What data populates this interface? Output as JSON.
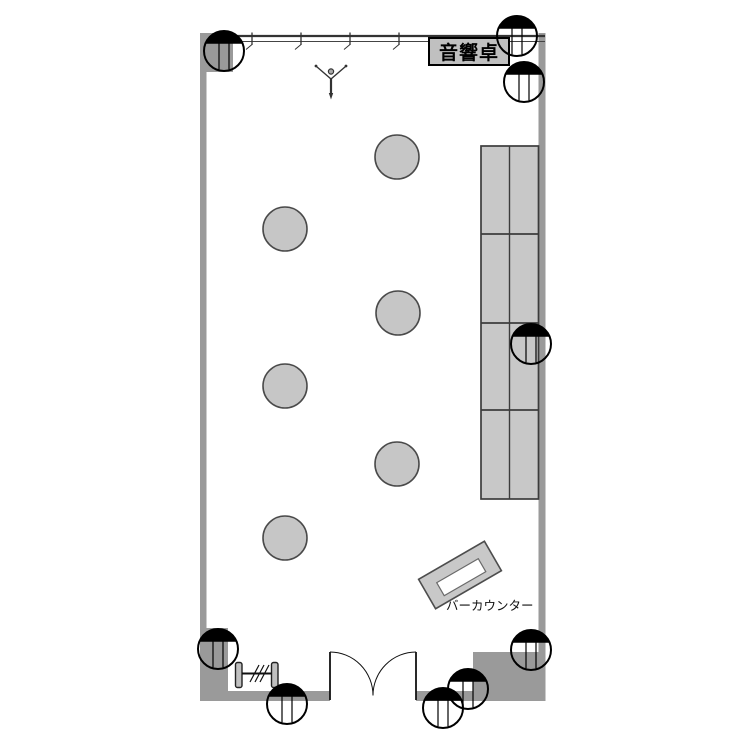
{
  "labels": {
    "sound_console": "音響卓",
    "bar_counter": "バーカウンター"
  },
  "palette": {
    "wall": "#9a9a9a",
    "furniture_fill": "#c8c8c8",
    "table_fill": "#c6c6c6",
    "console_fill": "#c0c0c0",
    "furniture_outline": "#4d4d4d",
    "ink": "#1a1a1a",
    "white": "#ffffff"
  },
  "plan": {
    "walls": [
      {
        "name": "left-wall",
        "x": 200,
        "y": 33,
        "w": 6.5,
        "h": 668
      },
      {
        "name": "top-left-wall-block",
        "x": 200,
        "y": 33,
        "w": 33,
        "h": 39
      },
      {
        "name": "right-wall",
        "x": 538.5,
        "y": 33,
        "w": 7,
        "h": 668
      },
      {
        "name": "bottom-left-wall-block",
        "x": 200,
        "y": 628,
        "w": 28,
        "h": 73
      },
      {
        "name": "bottom-wall-left",
        "x": 226,
        "y": 691,
        "w": 104,
        "h": 10
      },
      {
        "name": "bottom-wall-right",
        "x": 416,
        "y": 691,
        "w": 59,
        "h": 10
      },
      {
        "name": "bottom-right-wall-block",
        "x": 473,
        "y": 652,
        "w": 70,
        "h": 49
      }
    ],
    "window_wall": {
      "x1": 233,
      "x2": 545,
      "y_top": 36,
      "y_bottom": 41.5,
      "ticks": [
        252,
        301,
        350,
        399
      ]
    },
    "console_box": {
      "x": 429,
      "y": 38,
      "w": 80,
      "h": 27
    },
    "bench": {
      "x": 481,
      "y": 146,
      "w": 57.5,
      "h": 353,
      "divider_x": 509.5,
      "divider_ys": [
        234,
        323,
        410
      ]
    },
    "tables": {
      "radius": 22,
      "centers": [
        [
          397,
          157
        ],
        [
          285,
          229
        ],
        [
          398,
          313
        ],
        [
          285,
          386
        ],
        [
          397,
          464
        ],
        [
          285,
          538
        ]
      ]
    },
    "counter": {
      "cx": 460,
      "cy": 575,
      "rotation": -30,
      "outer_w": 76,
      "outer_h": 34,
      "inner": {
        "x": -24,
        "y": -5,
        "w": 48,
        "h": 15
      }
    },
    "door": {
      "left_x": 330,
      "right_x": 416,
      "top_y": 652,
      "floor_y": 695.5
    },
    "partition": {
      "cap_w": 6.5,
      "cap_h": 25,
      "caps": [
        [
          235.5,
          662.5
        ],
        [
          271.5,
          662.5
        ]
      ],
      "rail": {
        "x1": 242,
        "x2": 271.5,
        "y": 673.5
      },
      "hatches": [
        [
          250,
          682,
          259,
          665
        ],
        [
          255,
          682,
          264,
          665
        ],
        [
          260,
          682,
          269,
          665
        ]
      ]
    },
    "stand": {
      "cx": 331,
      "cy": 82
    },
    "columns": {
      "radius": 20,
      "chord_dy": 8,
      "line_dx": 5,
      "centers": [
        [
          224,
          51
        ],
        [
          517,
          36
        ],
        [
          524,
          82
        ],
        [
          531,
          344
        ],
        [
          218,
          649
        ],
        [
          287,
          704
        ],
        [
          443,
          708
        ],
        [
          468,
          689
        ],
        [
          531,
          650
        ]
      ]
    }
  }
}
